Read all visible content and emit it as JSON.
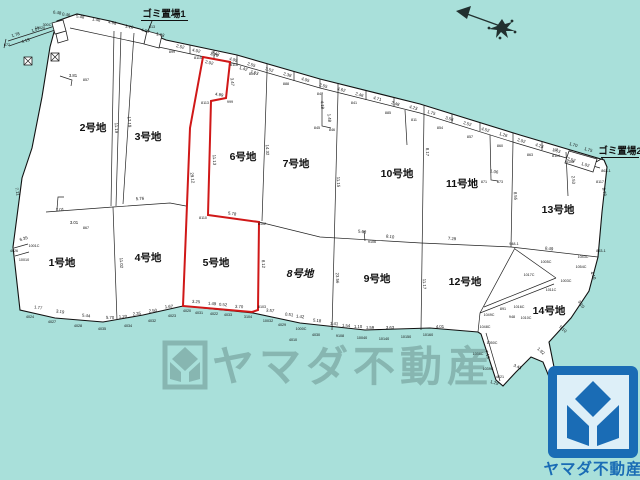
{
  "colors": {
    "water": "#a9e0da",
    "land": "#ffffff",
    "line": "#222222",
    "highlight_red": "#d01818",
    "logo_blue": "#1a6cb5",
    "watermark_gray": "#5e8480"
  },
  "watermark": {
    "text": "ヤマダ不動産"
  },
  "logo": {
    "text": "ヤマダ不動産"
  },
  "annotations": {
    "garbage1": "ゴミ置場1",
    "garbage2": "ゴミ置場2"
  },
  "lots": [
    {
      "name": "1号地",
      "x": 62,
      "y": 266
    },
    {
      "name": "2号地",
      "x": 93,
      "y": 131
    },
    {
      "name": "3号地",
      "x": 148,
      "y": 140
    },
    {
      "name": "4号地",
      "x": 148,
      "y": 261
    },
    {
      "name": "5号地",
      "x": 216,
      "y": 266
    },
    {
      "name": "6号地",
      "x": 243,
      "y": 160
    },
    {
      "name": "7号地",
      "x": 296,
      "y": 167
    },
    {
      "name": "8号地",
      "x": 300,
      "y": 277,
      "italic": true
    },
    {
      "name": "9号地",
      "x": 377,
      "y": 282
    },
    {
      "name": "10号地",
      "x": 397,
      "y": 177
    },
    {
      "name": "11号地",
      "x": 462,
      "y": 187
    },
    {
      "name": "12号地",
      "x": 465,
      "y": 285
    },
    {
      "name": "13号地",
      "x": 558,
      "y": 213
    },
    {
      "name": "14号地",
      "x": 549,
      "y": 314
    }
  ],
  "dim_labels": [
    [
      "1.78",
      16,
      36,
      -18
    ],
    [
      "4.13",
      26,
      42,
      -18
    ],
    [
      "1.07",
      36,
      31,
      -18
    ],
    [
      "6.48",
      57,
      14,
      8
    ],
    [
      "0.46",
      66,
      16,
      8
    ],
    [
      "5.48",
      80,
      18,
      10
    ],
    [
      "1.46",
      96,
      21,
      12
    ],
    [
      "4.68",
      112,
      24,
      12
    ],
    [
      "1.10",
      129,
      28,
      12
    ],
    [
      "4.09",
      145,
      32,
      13
    ],
    [
      "1.13",
      160,
      36,
      13
    ],
    [
      "2.52",
      180,
      48,
      14
    ],
    [
      "4.02",
      196,
      52,
      14
    ],
    [
      "2.70",
      214,
      56,
      15
    ],
    [
      "4.05",
      233,
      61,
      15
    ],
    [
      "2.55",
      251,
      66,
      16
    ],
    [
      "3.52",
      269,
      71,
      16
    ],
    [
      "2.38",
      287,
      76,
      16
    ],
    [
      "4.05",
      305,
      81,
      16
    ],
    [
      "2.55",
      323,
      87,
      16
    ],
    [
      "4.62",
      341,
      91,
      15
    ],
    [
      "2.46",
      359,
      96,
      15
    ],
    [
      "4.71",
      377,
      100,
      15
    ],
    [
      "2.48",
      395,
      105,
      15
    ],
    [
      "4.23",
      413,
      109,
      15
    ],
    [
      "1.75",
      431,
      114,
      16
    ],
    [
      "3.56",
      449,
      120,
      16
    ],
    [
      "2.52",
      467,
      125,
      16
    ],
    [
      "4.52",
      485,
      131,
      16
    ],
    [
      "1.26",
      503,
      136,
      16
    ],
    [
      "2.02",
      521,
      142,
      16
    ],
    [
      "4.23",
      539,
      147,
      16
    ],
    [
      "1.53",
      556,
      152,
      16
    ],
    [
      "1.70",
      573,
      146,
      16
    ],
    [
      "1.75",
      588,
      151,
      16
    ],
    [
      "2.52",
      571,
      161,
      16
    ],
    [
      "1.02",
      585,
      166,
      16
    ],
    [
      "1.42",
      243,
      70,
      15
    ],
    [
      "7.63",
      254,
      74,
      15
    ],
    [
      "2.42",
      215,
      55,
      14
    ],
    [
      "2.02",
      209,
      64,
      14
    ],
    [
      "3.47",
      231,
      82,
      84
    ],
    [
      "4.99",
      219,
      96,
      10
    ],
    [
      "11.13",
      213,
      160,
      87
    ],
    [
      "29.12",
      191,
      178,
      83
    ],
    [
      "5.78",
      232,
      215,
      8
    ],
    [
      "8.12",
      262,
      264,
      87
    ],
    [
      "3.25",
      196,
      303,
      4
    ],
    [
      "1.49",
      212,
      305,
      4
    ],
    [
      "0.52",
      223,
      306,
      4
    ],
    [
      "3.70",
      239,
      308,
      4
    ],
    [
      "17.19",
      128,
      122,
      86
    ],
    [
      "11.19",
      115,
      128,
      87
    ],
    [
      "11.02",
      120,
      263,
      87
    ],
    [
      "14.32",
      266,
      150,
      87
    ],
    [
      "11.15",
      337,
      182,
      88
    ],
    [
      "23.56",
      336,
      278,
      88
    ],
    [
      "8.17",
      426,
      152,
      88
    ],
    [
      "11.17",
      423,
      284,
      88
    ],
    [
      "8.55",
      514,
      196,
      87
    ],
    [
      "2.53",
      572,
      180,
      85
    ],
    [
      "8.78",
      603,
      192,
      80
    ],
    [
      "1.48",
      328,
      118,
      85
    ],
    [
      "4.18",
      321,
      105,
      85
    ],
    [
      "1.06",
      494,
      173,
      10
    ],
    [
      "3.01",
      74,
      224,
      0
    ],
    [
      "3.81",
      73,
      77,
      0
    ],
    [
      "5.76",
      140,
      200,
      -3
    ],
    [
      "8.01",
      60,
      211,
      -3
    ],
    [
      "5.68",
      362,
      233,
      7
    ],
    [
      "8.10",
      390,
      238,
      7
    ],
    [
      "7.29",
      452,
      240,
      3
    ],
    [
      "8.49",
      549,
      250,
      6
    ],
    [
      "1.77",
      38,
      309,
      8
    ],
    [
      "3.19",
      60,
      313,
      8
    ],
    [
      "5.44",
      86,
      317,
      7
    ],
    [
      "5.70",
      110,
      319,
      2
    ],
    [
      "1.20",
      123,
      318,
      -3
    ],
    [
      "2.35",
      137,
      315,
      -6
    ],
    [
      "2.50",
      153,
      312,
      -6
    ],
    [
      "1.67",
      169,
      308,
      -4
    ],
    [
      "3.57",
      270,
      312,
      6
    ],
    [
      "0.51",
      289,
      316,
      6
    ],
    [
      "1.42",
      300,
      318,
      6
    ],
    [
      "5.18",
      317,
      322,
      6
    ],
    [
      "1.41",
      334,
      325,
      4
    ],
    [
      "1.54",
      346,
      327,
      4
    ],
    [
      "1.10",
      358,
      328,
      2
    ],
    [
      "1.59",
      370,
      329,
      1
    ],
    [
      "3.63",
      390,
      329,
      0
    ],
    [
      "4.01",
      440,
      328,
      -1
    ],
    [
      "7.19",
      486,
      355,
      72
    ],
    [
      "1.29",
      494,
      384,
      15
    ],
    [
      "3.43",
      517,
      368,
      22
    ],
    [
      "5.10",
      562,
      330,
      42
    ],
    [
      "3.10",
      580,
      305,
      55
    ],
    [
      "4.10",
      592,
      276,
      68
    ],
    [
      "1.92",
      540,
      352,
      42
    ],
    [
      "7.35",
      552,
      372,
      45
    ],
    [
      "7.11",
      16,
      192,
      78
    ],
    [
      "6.35",
      24,
      240,
      -15
    ]
  ],
  "pt_labels": [
    [
      "672",
      7,
      46
    ],
    [
      "300C",
      47,
      26
    ],
    [
      "10020",
      40,
      29
    ],
    [
      "899",
      172,
      53
    ],
    [
      "8115",
      198,
      59
    ],
    [
      "8116",
      234,
      66
    ],
    [
      "804",
      252,
      75
    ],
    [
      "888",
      286,
      85
    ],
    [
      "847",
      320,
      95
    ],
    [
      "841",
      354,
      104
    ],
    [
      "885",
      388,
      114
    ],
    [
      "811",
      414,
      121
    ],
    [
      "854",
      440,
      129
    ],
    [
      "857",
      470,
      138
    ],
    [
      "860",
      500,
      147
    ],
    [
      "863",
      530,
      156
    ],
    [
      "47",
      556,
      151
    ],
    [
      "863-1",
      606,
      172
    ],
    [
      "8117",
      600,
      183
    ],
    [
      "853-1",
      601,
      252
    ],
    [
      "8113",
      205,
      104
    ],
    [
      "999",
      230,
      103
    ],
    [
      "8110",
      203,
      219
    ],
    [
      "8102",
      262,
      225
    ],
    [
      "8103",
      262,
      308
    ],
    [
      "4024",
      30,
      318
    ],
    [
      "4027",
      52,
      323
    ],
    [
      "4028",
      78,
      327
    ],
    [
      "4035",
      102,
      330
    ],
    [
      "4034",
      128,
      327
    ],
    [
      "4032",
      152,
      322
    ],
    [
      "4023",
      172,
      317
    ],
    [
      "4020",
      187,
      312
    ],
    [
      "4031",
      199,
      314
    ],
    [
      "4022",
      214,
      315
    ],
    [
      "4033",
      228,
      316
    ],
    [
      "3104",
      248,
      318
    ],
    [
      "10032",
      268,
      322
    ],
    [
      "4029",
      282,
      326
    ],
    [
      "1000C",
      301,
      330
    ],
    [
      "4030",
      316,
      336
    ],
    [
      "4010",
      293,
      341
    ],
    [
      "9108",
      340,
      337
    ],
    [
      "10040",
      362,
      339
    ],
    [
      "10140",
      384,
      340
    ],
    [
      "10150",
      406,
      338
    ],
    [
      "10160",
      428,
      336
    ],
    [
      "4026",
      14,
      252
    ],
    [
      "1001C",
      34,
      247
    ],
    [
      "10010",
      24,
      261
    ],
    [
      "857",
      86,
      81
    ],
    [
      "867",
      86,
      229
    ],
    [
      "948-1",
      514,
      245
    ],
    [
      "948",
      512,
      318
    ],
    [
      "891",
      503,
      310
    ],
    [
      "1005C",
      546,
      263
    ],
    [
      "1017C",
      529,
      276
    ],
    [
      "1003C",
      566,
      282
    ],
    [
      "1011C",
      551,
      291
    ],
    [
      "1016C",
      519,
      308
    ],
    [
      "1010C",
      526,
      319
    ],
    [
      "1043C",
      583,
      258
    ],
    [
      "1054C",
      581,
      268
    ],
    [
      "1049C",
      489,
      316
    ],
    [
      "1048C",
      485,
      328
    ],
    [
      "1050C",
      492,
      344
    ],
    [
      "1038C",
      478,
      355
    ],
    [
      "1039C",
      488,
      370
    ],
    [
      "4021",
      500,
      378
    ],
    [
      "845",
      317,
      129
    ],
    [
      "846",
      332,
      131
    ],
    [
      "871",
      484,
      183
    ],
    [
      "873",
      500,
      183
    ],
    [
      "8114",
      556,
      157
    ],
    [
      "8108",
      570,
      163
    ],
    [
      "813",
      152,
      28
    ],
    [
      "9106",
      372,
      243
    ]
  ]
}
